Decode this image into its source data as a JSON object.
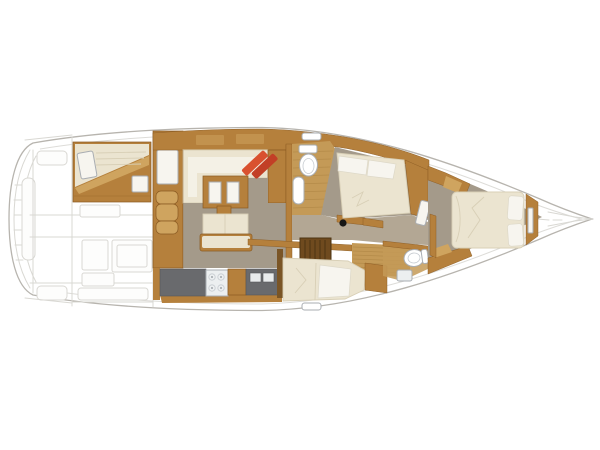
{
  "meta": {
    "description": "Top-down interior layout floor plan of a sailing yacht, bow pointing right, cockpit shown as faint ghost line-art at the stern (left)",
    "canvas": {
      "width": 600,
      "height": 450
    }
  },
  "colors": {
    "page_bg": "#ffffff",
    "hull_fill": "#ffffff",
    "wood": "#b5803c",
    "wood_light": "#cfa45f",
    "wood_dark": "#7a5526",
    "teak": "#c49a57",
    "floor": "#a49a8a",
    "floor_light": "#b3a794",
    "cream": "#ebe4d0",
    "seat_white": "#f4f1e6",
    "off_white": "#f7f5ef",
    "white": "#ffffff",
    "counter": "#696a6d",
    "counter_inset": "#e8ebec",
    "stove_white": "#eceff0",
    "louver": "#6f4a1e",
    "red": "#d9512f",
    "red_dark": "#c23f26",
    "mast": "#161616"
  },
  "elements": {
    "fixtures": [
      "toilet-icon",
      "sink-icon",
      "stove-icon",
      "bed",
      "pillow",
      "companionway-steps",
      "mast-step",
      "deck-hatch"
    ],
    "rooms": [
      "cockpit-ghost",
      "aft-cabin",
      "companionway",
      "saloon",
      "galley",
      "upper-head",
      "upper-cabin",
      "corridor",
      "lower-cabin",
      "lower-head",
      "bow-cabin"
    ]
  }
}
